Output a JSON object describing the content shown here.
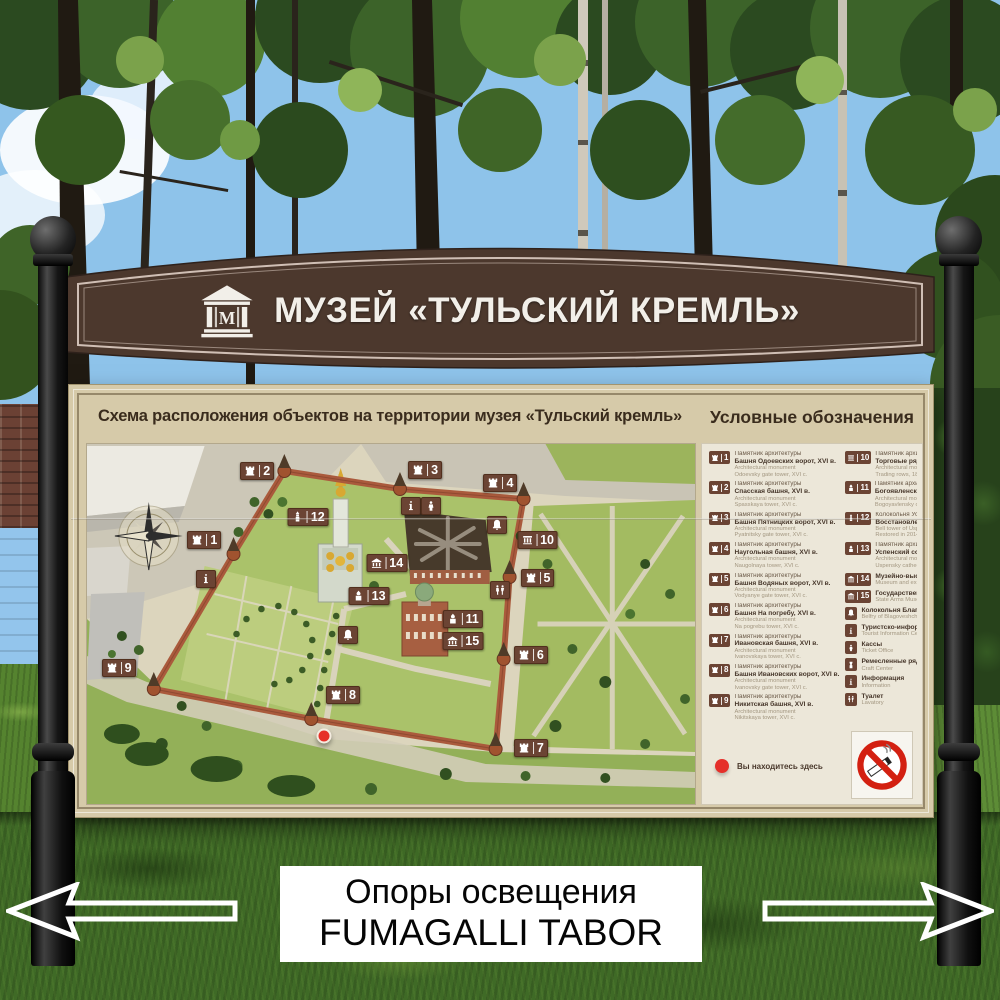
{
  "header_sign": {
    "title": "МУЗЕЙ «ТУЛЬСКИЙ КРЕМЛЬ»",
    "logo_letter": "М",
    "bg_color": "#4c382d",
    "text_color": "#f2efe9"
  },
  "board": {
    "map_title": "Схема расположения объектов на территории музея «Тульский кремль»",
    "legend_title": "Условные обозначения",
    "you_are_here": "Вы находитесь здесь"
  },
  "map": {
    "compass": "compass-rose",
    "you_are_here_dot": {
      "x": 39.0,
      "y": 81.1
    },
    "markers": [
      {
        "num": "1",
        "icon": "tower",
        "x": 19.3,
        "y": 26.7
      },
      {
        "num": "2",
        "icon": "tower",
        "x": 28.0,
        "y": 7.5
      },
      {
        "num": "3",
        "icon": "tower",
        "x": 55.6,
        "y": 7.2
      },
      {
        "num": "4",
        "icon": "tower",
        "x": 68.0,
        "y": 10.8
      },
      {
        "num": "5",
        "icon": "tower",
        "x": 74.1,
        "y": 37.2
      },
      {
        "num": "6",
        "icon": "tower",
        "x": 73.0,
        "y": 58.6
      },
      {
        "num": "7",
        "icon": "tower",
        "x": 73.0,
        "y": 84.4
      },
      {
        "num": "8",
        "icon": "tower",
        "x": 42.1,
        "y": 69.7
      },
      {
        "num": "9",
        "icon": "tower",
        "x": 5.2,
        "y": 62.2
      },
      {
        "num": "10",
        "icon": "columns",
        "x": 74.1,
        "y": 26.7
      },
      {
        "num": "11",
        "icon": "church",
        "x": 61.8,
        "y": 48.6
      },
      {
        "num": "12",
        "icon": "belltower",
        "x": 36.4,
        "y": 20.3
      },
      {
        "num": "13",
        "icon": "church",
        "x": 46.4,
        "y": 42.2
      },
      {
        "num": "14",
        "icon": "museum",
        "x": 49.3,
        "y": 33.1
      },
      {
        "num": "15",
        "icon": "museum",
        "x": 61.8,
        "y": 54.7
      },
      {
        "icon": "info",
        "x": 19.5,
        "y": 37.5
      },
      {
        "icon": "info",
        "x": 53.3,
        "y": 17.2
      },
      {
        "icon": "person",
        "x": 56.6,
        "y": 17.2
      },
      {
        "icon": "bell",
        "x": 67.5,
        "y": 22.5
      },
      {
        "icon": "bell",
        "x": 43.0,
        "y": 53.1
      },
      {
        "icon": "wc",
        "x": 67.9,
        "y": 40.6
      }
    ]
  },
  "legend": {
    "column_left": [
      {
        "num": "1",
        "icon": "tower",
        "l1": "Памятник архитектуры",
        "l2": "Башня Одоевских ворот, XVI в.",
        "l3": "Architectural monument",
        "l4": "Odoevsky gate tower, XVI c."
      },
      {
        "num": "2",
        "icon": "tower",
        "l1": "Памятник архитектуры",
        "l2": "Спасская башня, XVI в.",
        "l3": "Architectural monument",
        "l4": "Spasskaya tower, XVI c."
      },
      {
        "num": "3",
        "icon": "tower",
        "l1": "Памятник архитектуры",
        "l2": "Башня Пятницких ворот, XVI в.",
        "l3": "Architectural monument",
        "l4": "Pyatnitsky gate tower, XVI c."
      },
      {
        "num": "4",
        "icon": "tower",
        "l1": "Памятник архитектуры",
        "l2": "Наугольная башня, XVI в.",
        "l3": "Architectural monument",
        "l4": "Naugolnaya tower, XVI c."
      },
      {
        "num": "5",
        "icon": "tower",
        "l1": "Памятник архитектуры",
        "l2": "Башня Водяных ворот, XVI в.",
        "l3": "Architectural monument",
        "l4": "Vodyanye gate tower, XVI c."
      },
      {
        "num": "6",
        "icon": "tower",
        "l1": "Памятник архитектуры",
        "l2": "Башня На погребу, XVI в.",
        "l3": "Architectural monument",
        "l4": "Na pogrebu tower, XVI c."
      },
      {
        "num": "7",
        "icon": "tower",
        "l1": "Памятник архитектуры",
        "l2": "Ивановская башня, XVI в.",
        "l3": "Architectural monument",
        "l4": "Ivanovskaya tower, XVI c."
      },
      {
        "num": "8",
        "icon": "tower",
        "l1": "Памятник архитектуры",
        "l2": "Башня Ивановских ворот, XVI в.",
        "l3": "Architectural monument",
        "l4": "Ivanovsky gate tower, XVI c."
      },
      {
        "num": "9",
        "icon": "tower",
        "l1": "Памятник архитектуры",
        "l2": "Никитская башня, XVI в.",
        "l3": "Architectural monument",
        "l4": "Nikitskaya tower, XVI c."
      }
    ],
    "column_right": [
      {
        "num": "10",
        "icon": "columns",
        "l1": "Памятник архитектуры",
        "l2": "Торговые ряды, 1837-1841",
        "l3": "Architectural monument",
        "l4": "Trading rows, 1837-1841"
      },
      {
        "num": "11",
        "icon": "church",
        "l1": "Памятник архитектуры",
        "l2": "Богоявленский собор, 1855-1862",
        "l3": "Architectural monument",
        "l4": "Bogoyavlensky cathedral, 1855-1862"
      },
      {
        "num": "12",
        "icon": "belltower",
        "l1": "Колокольня Успенского собора",
        "l2": "Восстановлена в 2014",
        "l3": "Bell tower of Uspensky cathedral",
        "l4": "Restored in 2014"
      },
      {
        "num": "13",
        "icon": "church",
        "l1": "Памятник архитектуры",
        "l2": "Успенский собор, 1762-1764",
        "l3": "Architectural monument",
        "l4": "Uspensky cathedral, 1762-1764"
      },
      {
        "num": "14",
        "icon": "museum",
        "l2": "Музейно-выставочный комплекс",
        "l3": "Museum and exhibition complex"
      },
      {
        "num": "15",
        "icon": "museum",
        "l2": "Государственный музей оружия",
        "l3": "State Arms Museum"
      },
      {
        "icon": "bell",
        "l2": "Колокольня Благовещенской церкви",
        "l3": "Belfry of Blagoveshchenskaya church"
      },
      {
        "icon": "info",
        "l2": "Туристско-информационный центр",
        "l3": "Tourist Information Center"
      },
      {
        "icon": "person",
        "l2": "Кассы",
        "l3": "Ticket Office"
      },
      {
        "icon": "craft",
        "l2": "Ремесленные ряды",
        "l3": "Craft Center"
      },
      {
        "icon": "info",
        "l2": "Информация",
        "l3": "Information"
      },
      {
        "icon": "wc",
        "l2": "Туалет",
        "l3": "Lavatory"
      }
    ]
  },
  "overlay": {
    "line1": "Опоры освещения",
    "line2": "FUMAGALLI TABOR"
  },
  "colors": {
    "sign_brown": "#4c382d",
    "board_beige": "#d6caa9",
    "marker_brown": "#6b4434",
    "you_are_here_red": "#e5302a",
    "no_smoking_red": "#d32011"
  }
}
